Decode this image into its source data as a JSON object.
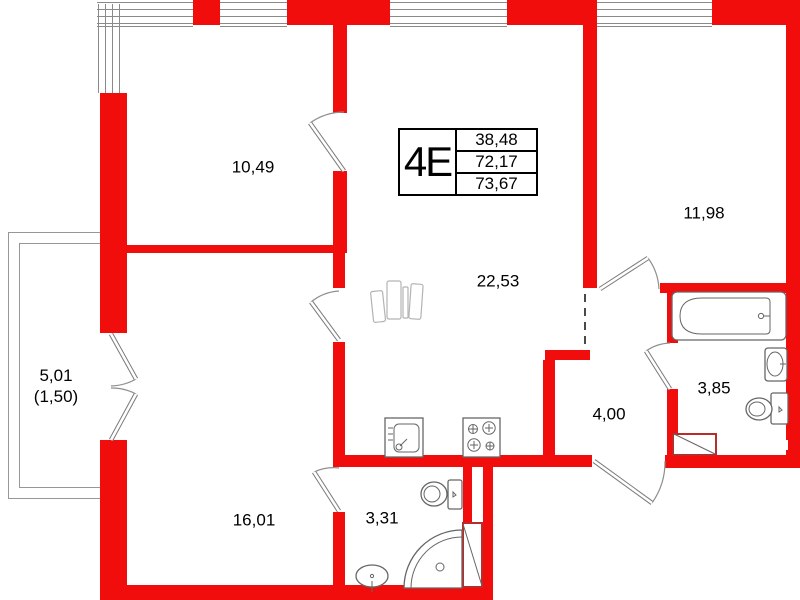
{
  "unit_card": {
    "type_label": "4E",
    "areas": [
      "38,48",
      "72,17",
      "73,67"
    ]
  },
  "rooms": [
    {
      "name": "bedroom-top-left",
      "area": "10,49"
    },
    {
      "name": "living-room-kitchen",
      "area": "22,53"
    },
    {
      "name": "bedroom-right",
      "area": "11,98"
    },
    {
      "name": "room-bottom-left",
      "area": "16,01"
    },
    {
      "name": "bathroom-small",
      "area": "3,31"
    },
    {
      "name": "hallway",
      "area": "4,00"
    },
    {
      "name": "bathroom-large",
      "area": "3,85"
    }
  ],
  "balcony": {
    "area": "5,01",
    "area_coefficient": "(1,50)"
  },
  "fixtures": [
    "bathtub",
    "wall-sink",
    "toilet",
    "corner-shower",
    "small-sink",
    "kitchen-sink",
    "stove",
    "wardrobe",
    "vent-shaft",
    "entry-door"
  ],
  "colors": {
    "wall_red": "#f20d0d",
    "thin_line_gray": "#8a8a8a",
    "text_black": "#000000"
  }
}
